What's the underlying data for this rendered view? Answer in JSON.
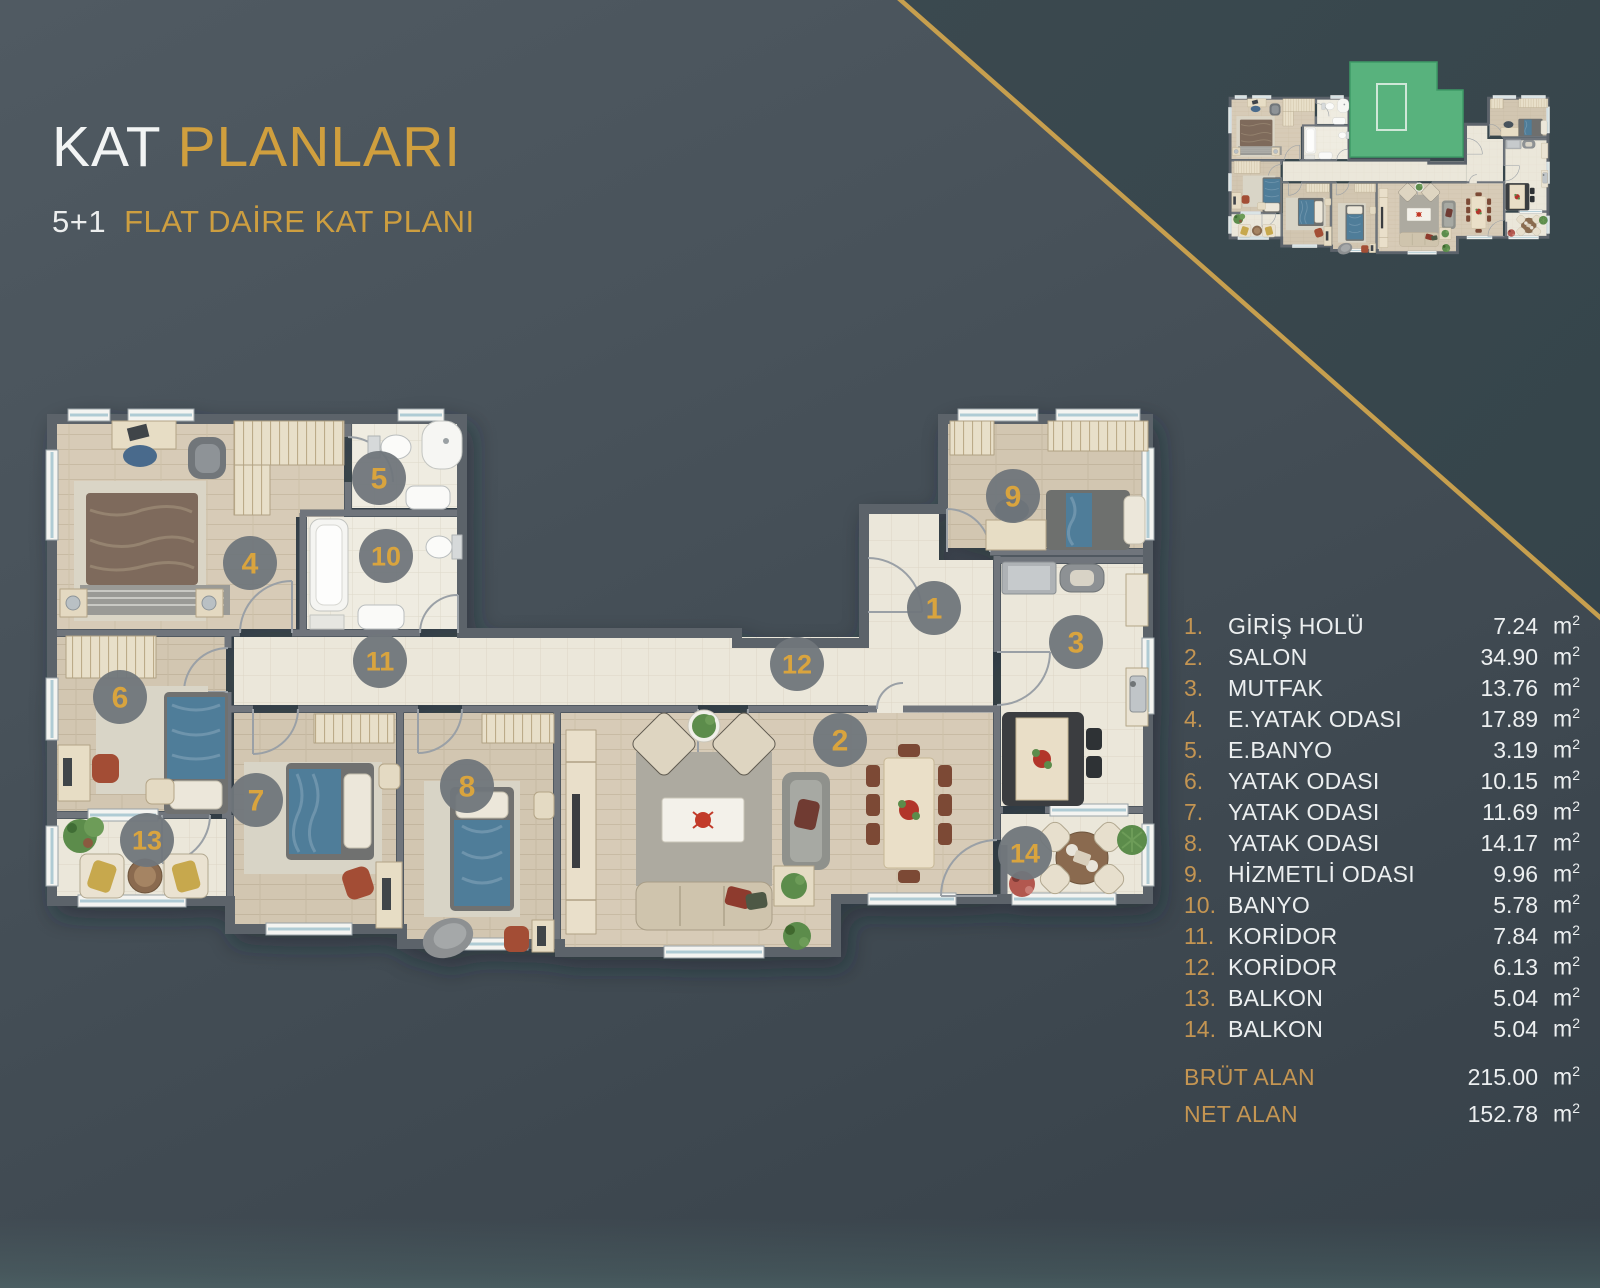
{
  "header": {
    "title_primary": "KAT",
    "title_secondary": "PLANLARI",
    "subtitle_prefix": "5+1",
    "subtitle_text": "FLAT DAİRE KAT PLANI"
  },
  "legend": {
    "unit_base": "m",
    "unit_sup": "2",
    "rooms": [
      {
        "no": "1.",
        "name": "GİRİŞ HOLÜ",
        "area": "7.24"
      },
      {
        "no": "2.",
        "name": "SALON",
        "area": "34.90"
      },
      {
        "no": "3.",
        "name": "MUTFAK",
        "area": "13.76"
      },
      {
        "no": "4.",
        "name": "E.YATAK ODASI",
        "area": "17.89"
      },
      {
        "no": "5.",
        "name": "E.BANYO",
        "area": "3.19"
      },
      {
        "no": "6.",
        "name": "YATAK ODASI",
        "area": "10.15"
      },
      {
        "no": "7.",
        "name": "YATAK ODASI",
        "area": "11.69"
      },
      {
        "no": "8.",
        "name": "YATAK ODASI",
        "area": "14.17"
      },
      {
        "no": "9.",
        "name": "HİZMETLİ ODASI",
        "area": "9.96"
      },
      {
        "no": "10.",
        "name": "BANYO",
        "area": "5.78"
      },
      {
        "no": "11.",
        "name": "KORİDOR",
        "area": "7.84"
      },
      {
        "no": "12.",
        "name": "KORİDOR",
        "area": "6.13"
      },
      {
        "no": "13.",
        "name": "BALKON",
        "area": "5.04"
      },
      {
        "no": "14.",
        "name": "BALKON",
        "area": "5.04"
      }
    ],
    "totals": [
      {
        "label": "BRÜT ALAN",
        "area": "215.00"
      },
      {
        "label": "NET ALAN",
        "area": "152.78"
      }
    ]
  },
  "floor_plan": {
    "markers": [
      {
        "label": "1",
        "x": 934,
        "y": 608
      },
      {
        "label": "2",
        "x": 840,
        "y": 740
      },
      {
        "label": "3",
        "x": 1076,
        "y": 642
      },
      {
        "label": "4",
        "x": 250,
        "y": 563
      },
      {
        "label": "5",
        "x": 379,
        "y": 478
      },
      {
        "label": "6",
        "x": 120,
        "y": 697
      },
      {
        "label": "7",
        "x": 256,
        "y": 800
      },
      {
        "label": "8",
        "x": 467,
        "y": 786
      },
      {
        "label": "9",
        "x": 1013,
        "y": 496
      },
      {
        "label": "10",
        "x": 386,
        "y": 556
      },
      {
        "label": "11",
        "x": 380,
        "y": 661
      },
      {
        "label": "12",
        "x": 797,
        "y": 664
      },
      {
        "label": "13",
        "x": 147,
        "y": 840
      },
      {
        "label": "14",
        "x": 1025,
        "y": 853
      }
    ],
    "marker_color": "#70767b",
    "marker_text_color": "#d9a43e"
  },
  "thumbnail": {
    "highlight_color": "#58b27d"
  },
  "colors": {
    "accent_gold": "#c79f4e",
    "title_gold": "#d09f3e",
    "background_dark": "#3a464d"
  }
}
